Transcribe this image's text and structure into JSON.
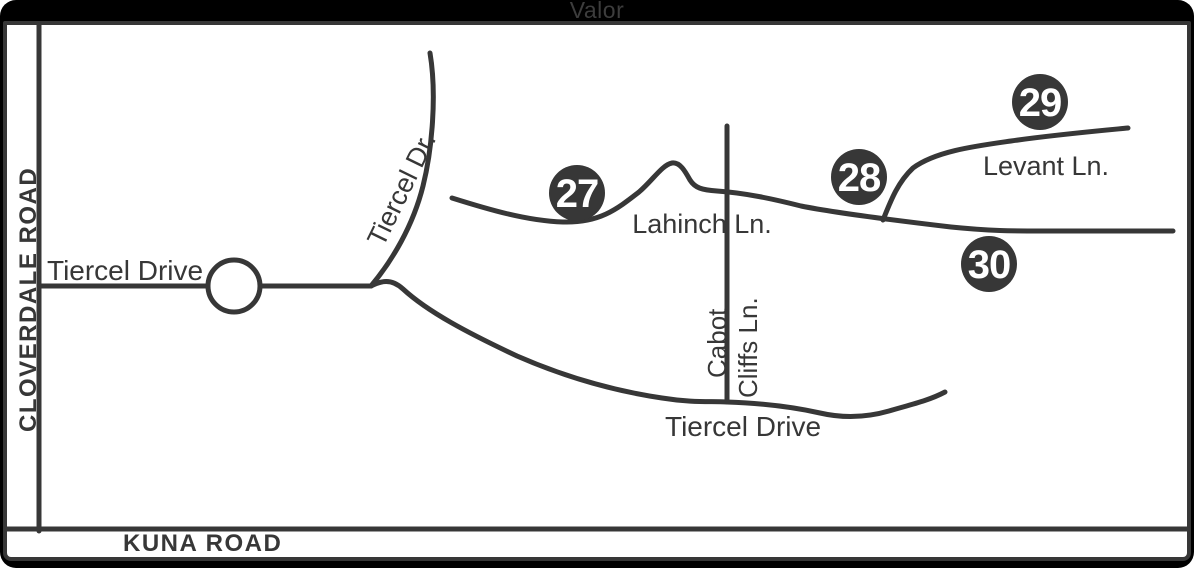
{
  "title": "Valor",
  "colors": {
    "frame": "#000000",
    "panel_background": "#ffffff",
    "ink": "#373737",
    "marker_fill": "#373737",
    "marker_text": "#ffffff"
  },
  "edge_roads": {
    "west": "CLOVERDALE ROAD",
    "south": "KUNA ROAD"
  },
  "roads": {
    "tiercel_drive_west": "Tiercel Drive",
    "tiercel_dr_north": "Tiercel Dr.",
    "tiercel_drive_south": "Tiercel Drive",
    "lahinch_ln": "Lahinch Ln.",
    "levant_ln": "Levant Ln.",
    "cabot_cliffs_line1": "Cabot",
    "cabot_cliffs_line2": "Cliffs Ln."
  },
  "markers": [
    {
      "number": "27"
    },
    {
      "number": "28"
    },
    {
      "number": "29"
    },
    {
      "number": "30"
    }
  ]
}
